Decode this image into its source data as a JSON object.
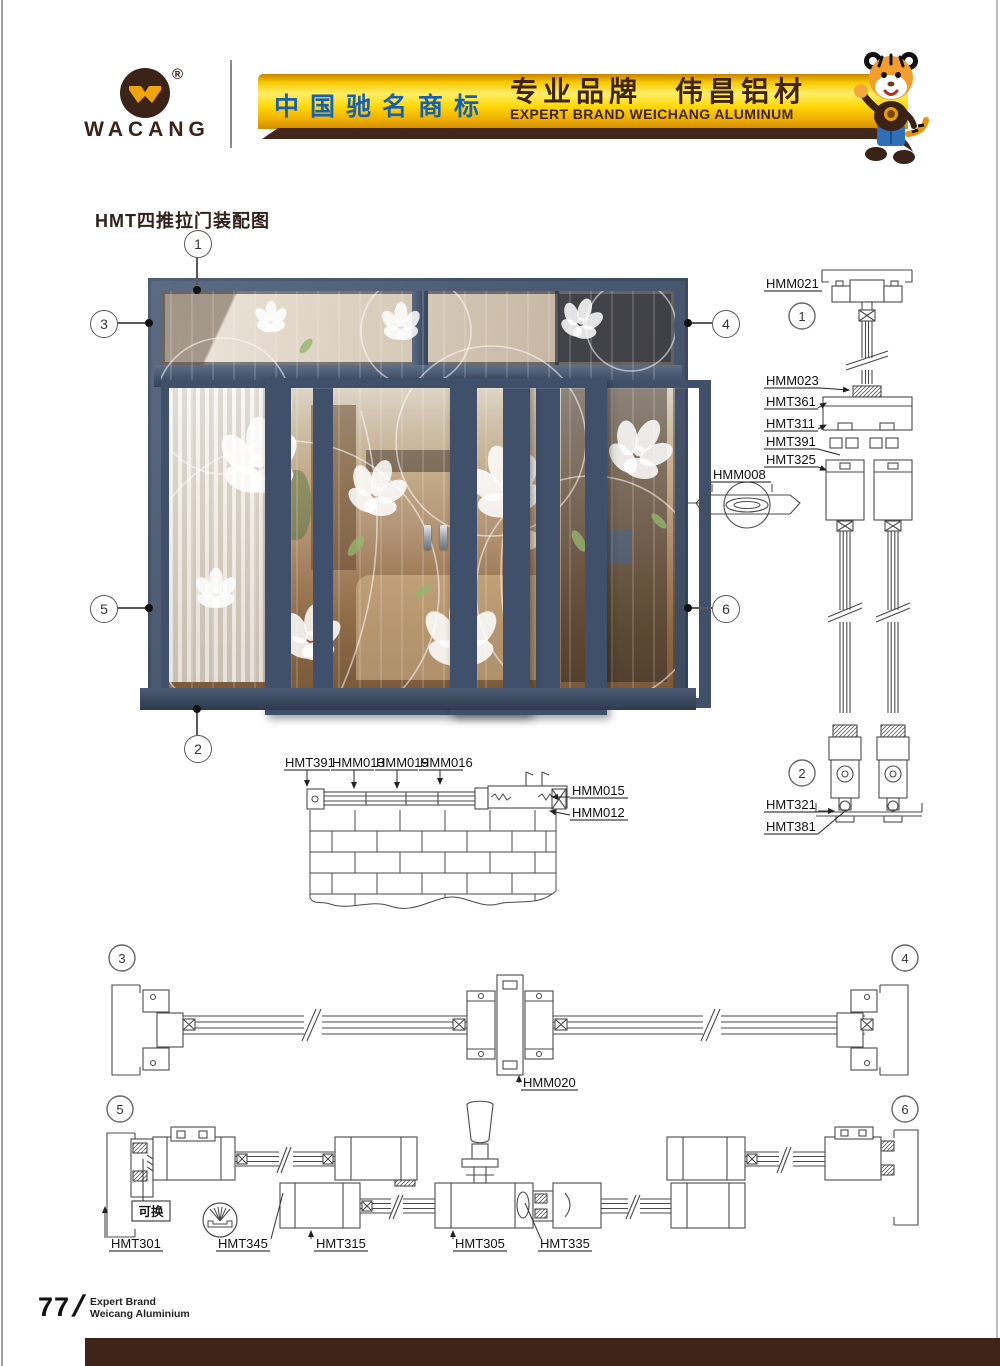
{
  "page_title": "HMT四推拉门装配图",
  "header": {
    "logo": {
      "text": "WACANG",
      "registered": "®"
    },
    "banner": {
      "cn_trademark": "中国驰名商标",
      "cn_slogan": "专业品牌　伟昌铝材",
      "en_slogan": "EXPERT BRAND WEICHANG ALUMINUM"
    },
    "colors": {
      "banner_gold": "#ffd90a",
      "trademark_blue": "#1660b4",
      "brand_brown": "#3f2418"
    }
  },
  "figure": {
    "callouts": {
      "c1": "1",
      "c2": "2",
      "c3": "3",
      "c4": "4",
      "c5": "5",
      "c6": "6"
    }
  },
  "right_section": {
    "callout_top": "1",
    "callout_bottom": "2",
    "labels": {
      "hmm021": "HMM021",
      "hmm023": "HMM023",
      "hmt361": "HMT361",
      "hmt311": "HMT311",
      "hmt391": "HMT391",
      "hmt325": "HMT325",
      "hmt321": "HMT321",
      "hmt381": "HMT381"
    }
  },
  "handle_detail": {
    "label": "HMM008"
  },
  "wall_section": {
    "labels": {
      "hmt391": "HMT391",
      "hmm013": "HMM013",
      "hmm019": "HMM019",
      "hmm016": "HMM016",
      "hmm015": "HMM015",
      "hmm012": "HMM012"
    }
  },
  "section_a": {
    "callout_left": "3",
    "callout_right": "4",
    "label_center": "HMM020"
  },
  "section_b": {
    "callout_left": "5",
    "callout_right": "6",
    "replaceable_label": "可换",
    "labels": {
      "hmt301": "HMT301",
      "hmt345": "HMT345",
      "hmt315": "HMT315",
      "hmt305": "HMT305",
      "hmt335": "HMT335"
    }
  },
  "footer": {
    "page_number": "77",
    "separator": "/",
    "line1": "Expert Brand",
    "line2": "Weicang Aluminium"
  }
}
